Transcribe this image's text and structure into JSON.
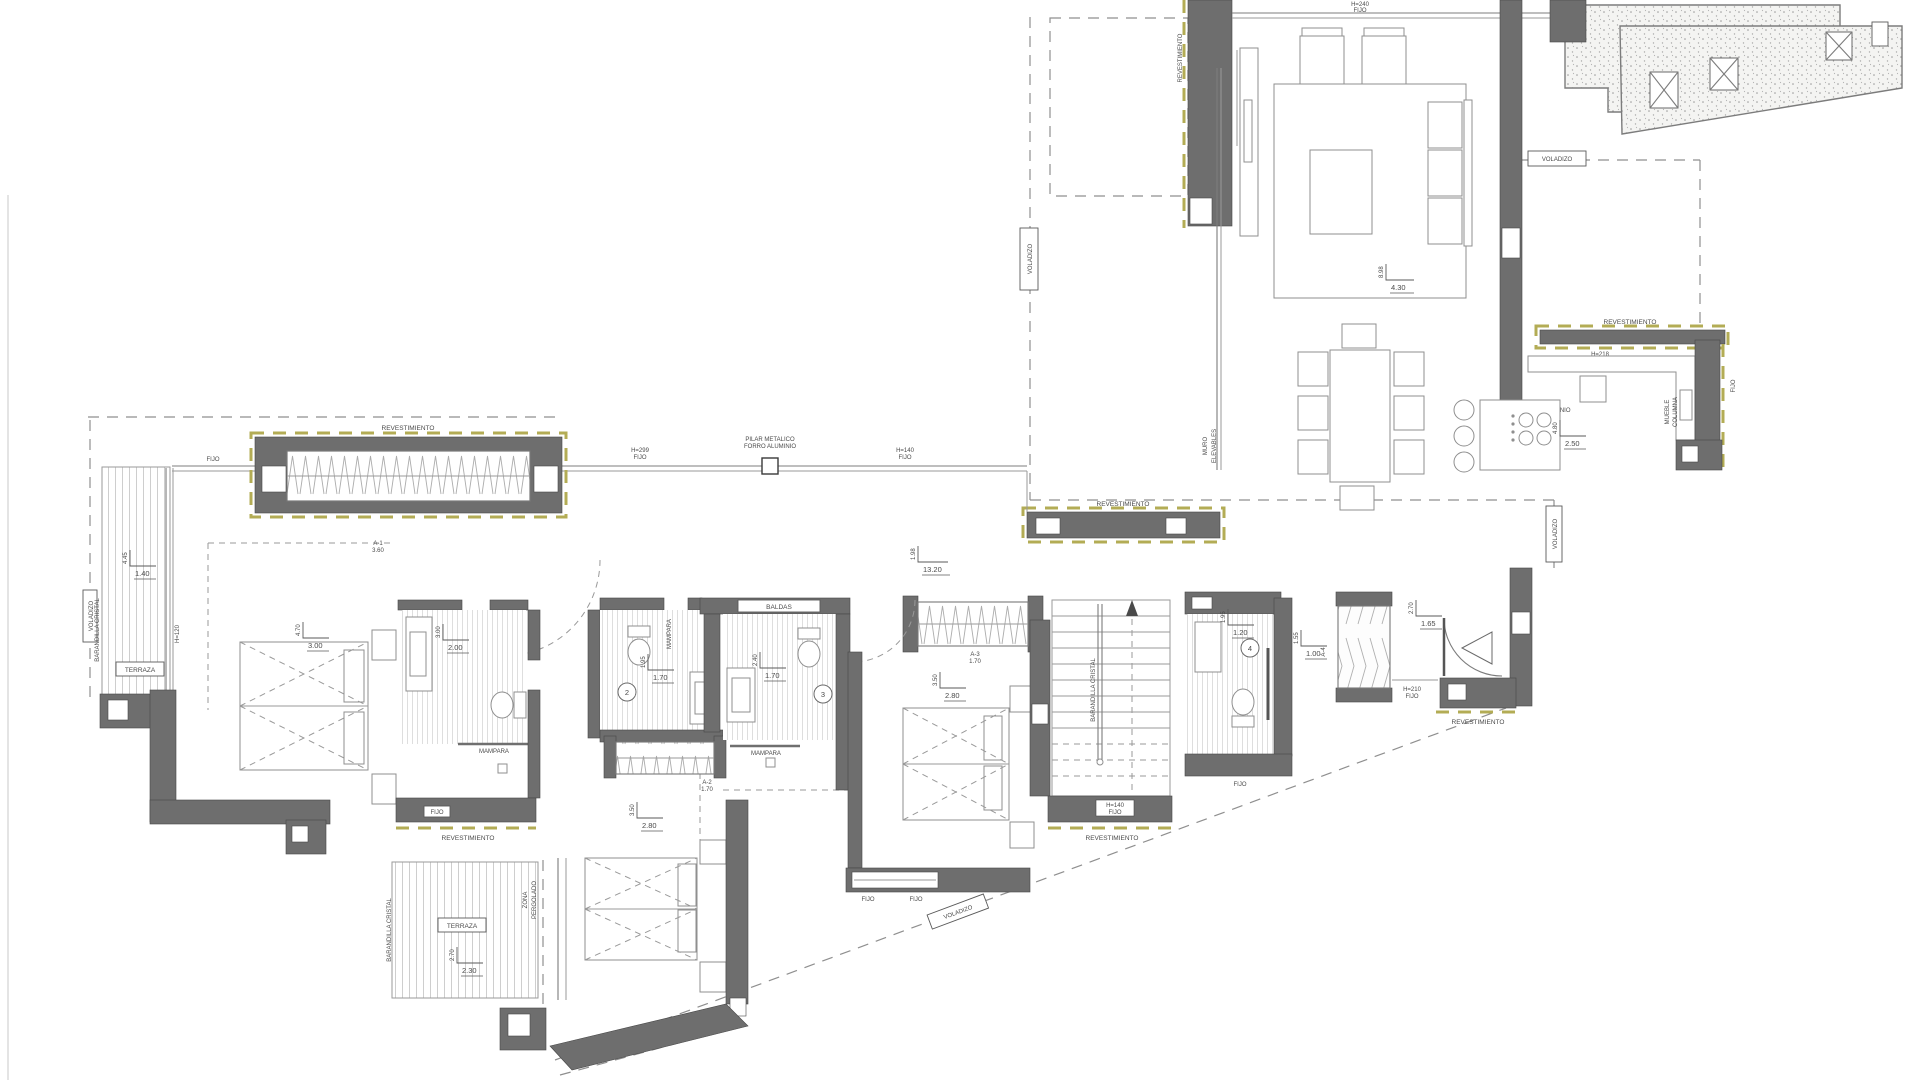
{
  "drawing": {
    "type": "architectural-floor-plan",
    "colors": {
      "wall": "#6e6e6e",
      "accent_olive": "#b3ac55",
      "line": "#9a9a9a",
      "text": "#4a4a4a",
      "background": "#ffffff"
    }
  },
  "labels": {
    "revestimiento": "REVESTIMIENTO",
    "voladizo": "VOLADIZO",
    "terraza": "TERRAZA",
    "fijo": "FIJO",
    "mampara": "MAMPARA",
    "baldas": "BALDAS",
    "muro": "MURO",
    "elevables": "ELEVABLES",
    "pilar_l1": "PILAR METALICO",
    "pilar_l2": "FORRO ALUMINIO",
    "barandilla": "BARANDILLA CRISTAL",
    "zona": "ZONA",
    "pergolado": "PERGOLADO",
    "aluminio": "ALUMINIO",
    "mueble": "MUEBLE",
    "columna": "COLUMNA",
    "h240": "H=240",
    "h299": "H=299",
    "h140": "H=140",
    "h218": "H=218",
    "h210": "H=210",
    "h120": "H=120",
    "a1": "A-1",
    "a1v": "3.60",
    "a2": "A-2",
    "a2v": "1.70",
    "a3": "A-3",
    "a3v": "1.70",
    "a4": "A-4",
    "num1": "1",
    "num2": "2",
    "num3": "3",
    "num4": "4",
    "corr_v": "1.98",
    "corr_h": "13.20",
    "living_v": "8.98",
    "living_h": "4.30",
    "kitchen_v": "4.80",
    "kitchen_h": "2.50",
    "terrnw_v": "4.45",
    "terrnw_h": "1.40",
    "bed1_v": "4.70",
    "bed1_h": "3.00",
    "bath1_v": "3.00",
    "bath1_h": "2.00",
    "bath2_v": "1.95",
    "bath2_h": "1.70",
    "bath3_v": "2.40",
    "bath3_h": "1.70",
    "bed2_v": "3.50",
    "bed2_h": "2.80",
    "bed3_v": "3.50",
    "bed3_h": "2.80",
    "bath4_v": "1.95",
    "bath4_h": "1.20",
    "ward_v": "1.55",
    "ward_h": "1.00",
    "entry_v": "2.70",
    "entry_h": "1.65",
    "terrsw_v": "2.70",
    "terrsw_h": "2.30"
  }
}
